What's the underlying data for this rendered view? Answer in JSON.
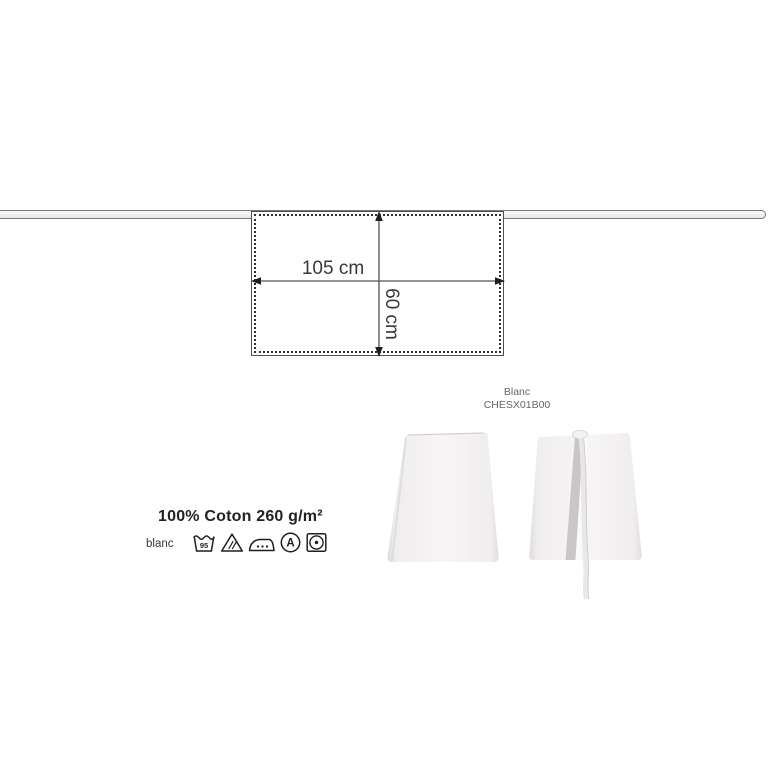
{
  "diagram": {
    "width_label": "105 cm",
    "height_label": "60 cm"
  },
  "product": {
    "color_name": "Blanc",
    "sku": "CHESX01B00"
  },
  "specs": {
    "fabric": "100% Coton 260 g/m²",
    "variant": "blanc",
    "care": {
      "wash_temp": "95",
      "dry_clean_letter": "A",
      "symbols": [
        "wash-tub",
        "bleach-triangle",
        "iron",
        "dry-clean-circle",
        "tumble-dry"
      ]
    }
  },
  "colors": {
    "background": "#ffffff",
    "line_dark": "#3c3c3c",
    "strap_outline": "#7a7a7a",
    "apron_white": "#f5f3f4",
    "apron_shadow": "#c8c6c7",
    "muted_text": "#666666"
  }
}
